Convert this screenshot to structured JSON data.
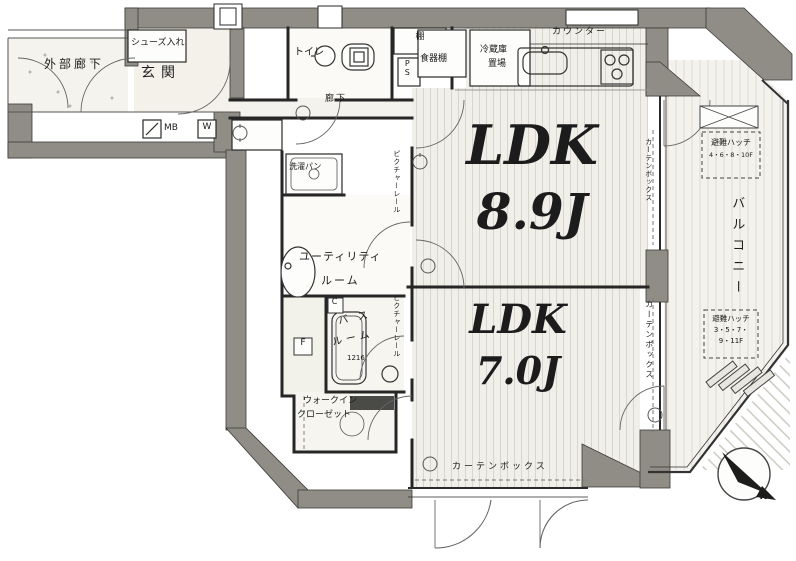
{
  "plan": {
    "type": "apartment-floor-plan",
    "colors": {
      "wall_gray": "#8f8d85",
      "line": "#2a2a2a",
      "floor_stripe": "#d8d5cb"
    },
    "labels": {
      "exterior_corridor": "外部廊下",
      "shoe_storage": "シューズ入れ",
      "entrance": "玄関",
      "mb": "MB",
      "w": "W",
      "toilet": "トイレ",
      "shelf": "棚",
      "pipe_space": "PS",
      "dish_shelf": "食器棚",
      "fridge_line1": "冷蔵庫",
      "fridge_line2": "置場",
      "counter": "カウンター",
      "corridor": "廊下",
      "picture_rail": "ピクチャーレール",
      "curtain_box": "カーテンボックス",
      "balcony": "バルコニー",
      "hatch_title": "避難ハッチ",
      "hatch1_floors": "4・6・8・10F",
      "hatch2_floors_line1": "3・5・7・",
      "hatch2_floors_line2": "9・11F",
      "utility_line1": "ユーティリティ",
      "utility_line2": "ルーム",
      "laundry_pan": "洗濯パン",
      "bathroom_line1": "バス",
      "bathroom_line2": "ルーム",
      "bath_size": "1216",
      "wic_line1": "ウォークイン",
      "wic_line2": "クローゼット",
      "fan_box": "F",
      "c_box": "C",
      "compass_north": "N"
    },
    "rooms": [
      {
        "name": "LDK",
        "size": "8.9J"
      },
      {
        "name": "LDK",
        "size": "7.0J"
      }
    ]
  }
}
